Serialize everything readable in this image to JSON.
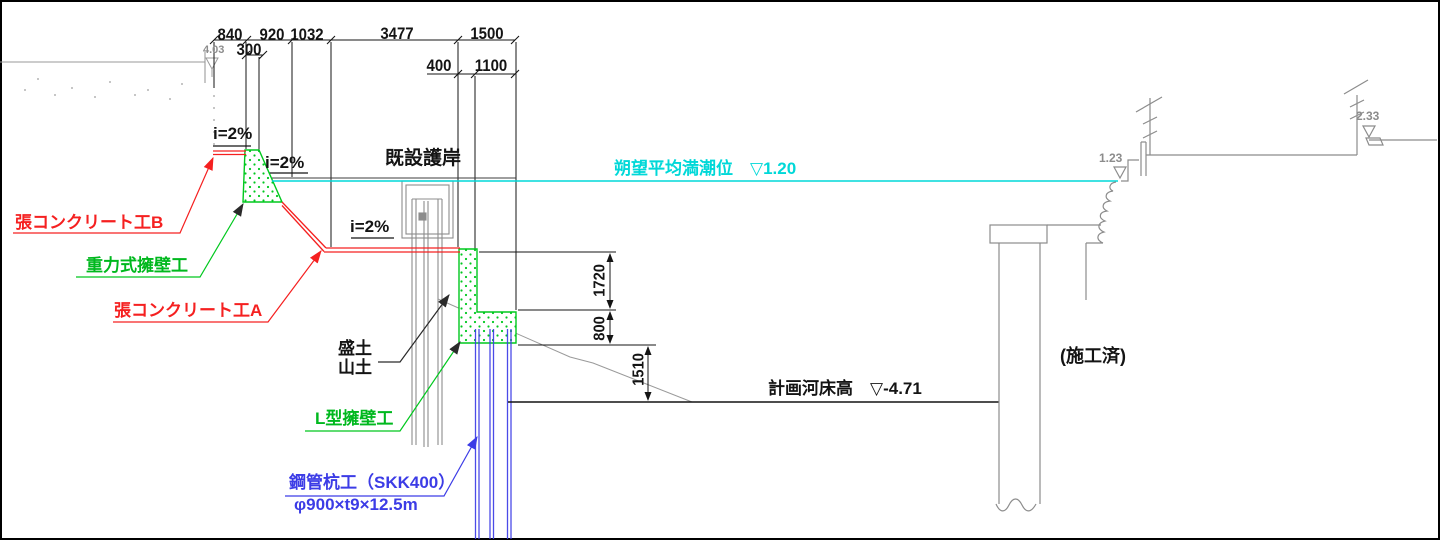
{
  "dimensions": {
    "top_chain": {
      "d840": "840",
      "d920": "920",
      "d1032": "1032",
      "d3477": "3477",
      "d1500": "1500"
    },
    "sub_chain": {
      "d300": "300",
      "d400": "400",
      "d1100": "1100"
    },
    "right_chain": {
      "d1720": "1720",
      "d800": "800",
      "d1510": "1510"
    }
  },
  "levels": {
    "ground_left": "4.03",
    "tide": "朔望平均満潮位　▽1.20",
    "riverbed": "計画河床高　▽-4.71",
    "crest_front": "1.23",
    "crest_back": "2.33"
  },
  "slopes": {
    "s1": "i=2%",
    "s2": "i=2%",
    "s3": "i=2%"
  },
  "labels": {
    "slab_concrete_b": "張コンクリート工B",
    "gravity_wall": "重力式擁壁工",
    "slab_concrete_a": "張コンクリート工A",
    "existing_revetment": "既設護岸",
    "fill_soil": "盛土",
    "mountain_soil": "山土",
    "l_wall": "L型擁壁工",
    "steel_pipe_pile": "鋼管杭工（SKK400）",
    "steel_pipe_pile_spec": "φ900×t9×12.5m",
    "completed": "(施工済)"
  },
  "colors": {
    "leader_red": "#f52020",
    "structure_green": "#00c81e",
    "pile_blue": "#3c3ce6",
    "tide_cyan": "#00d8d8",
    "existing_gray": "#8c8c8c",
    "line_black": "#141414"
  }
}
